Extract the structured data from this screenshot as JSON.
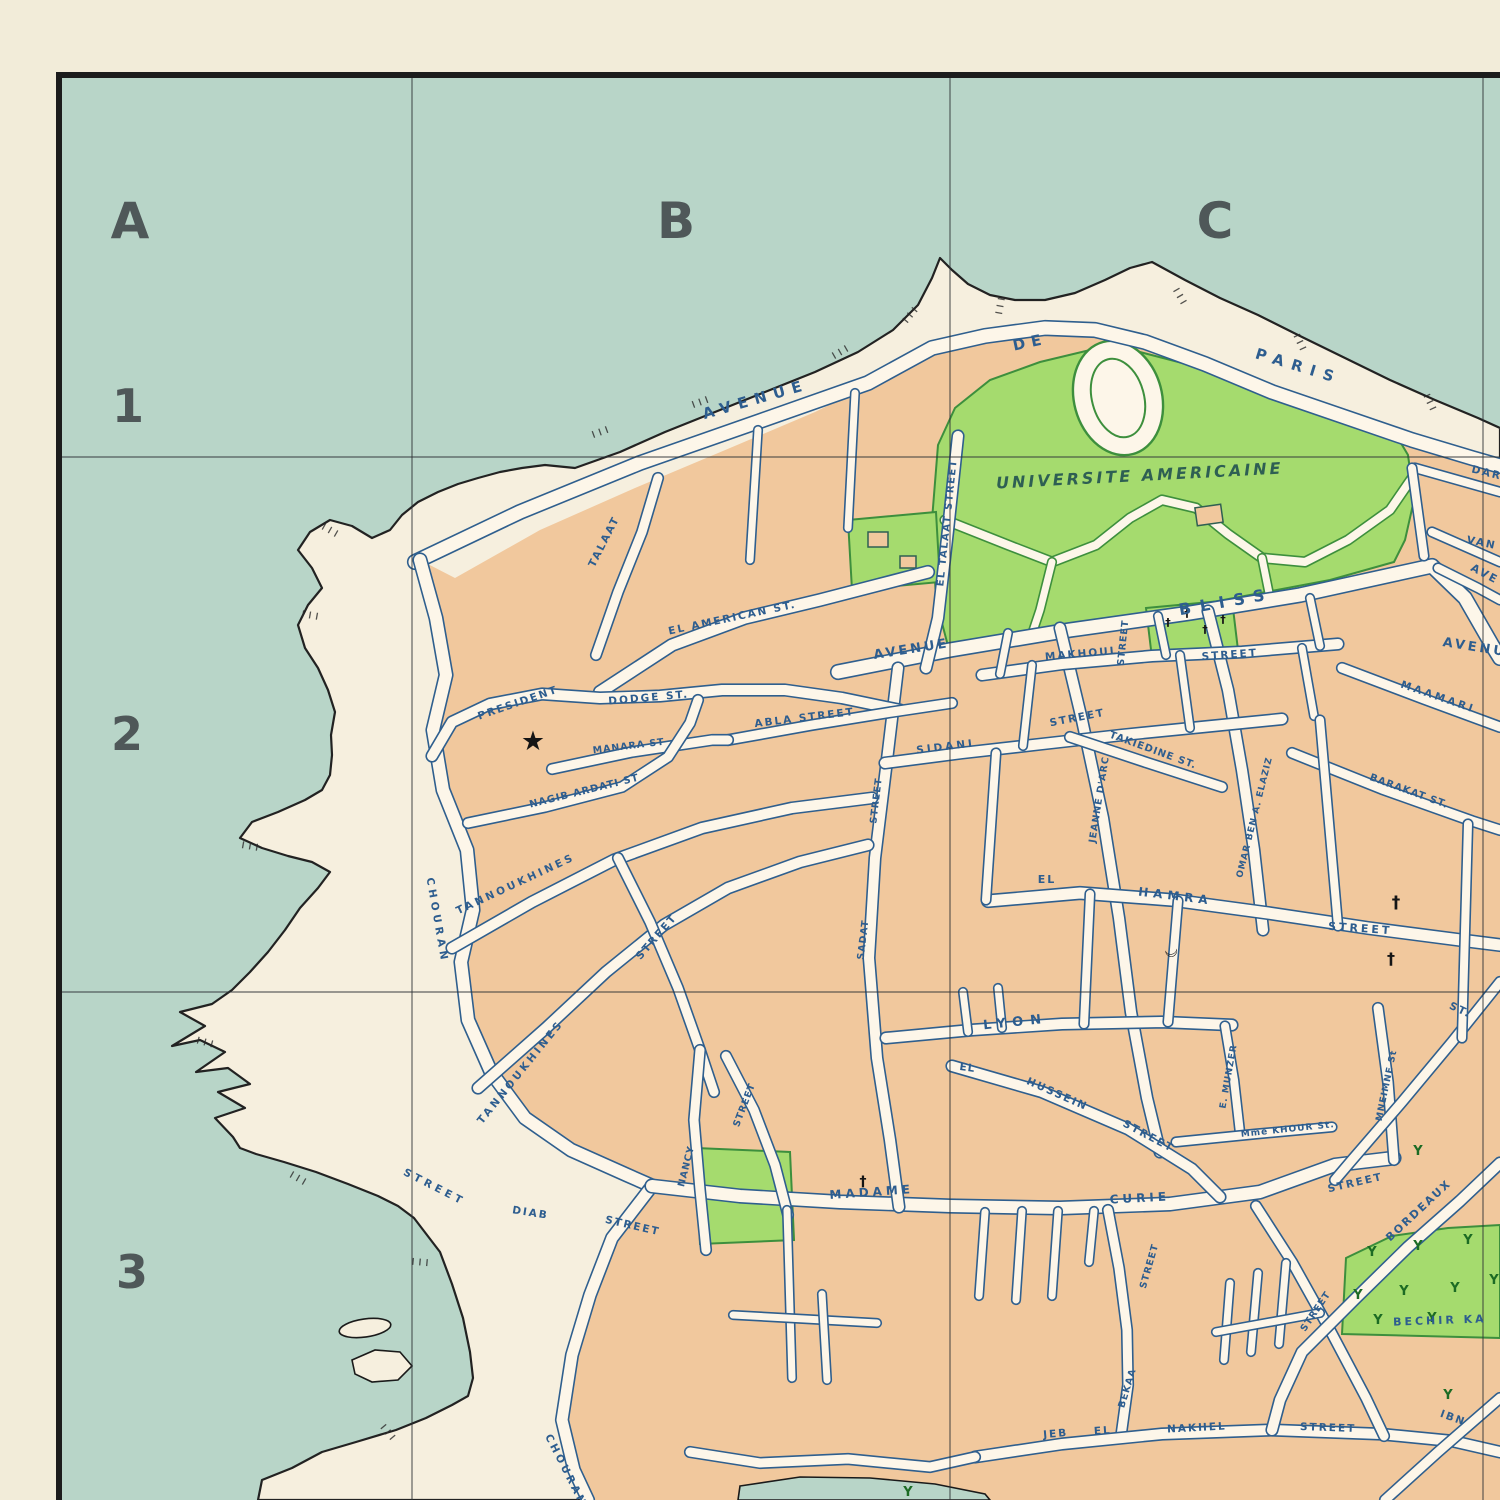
{
  "map_kind": "vintage-city-plan",
  "colors": {
    "sea": "#b8d5c8",
    "paper": "#f2ecd9",
    "land": "#f6efde",
    "block": "#f1c89d",
    "road": "#fdf6e9",
    "road_edge": "#2f5f8e",
    "park": "#a5db6e",
    "park_edge": "#3d8f3d",
    "label": "#2d5d8f",
    "university_text": "#2e5f53",
    "ink": "#222222",
    "grid": "#2f3337"
  },
  "grid": {
    "border": {
      "top_y": 72,
      "left_x": 56,
      "thickness": 6
    },
    "vlines": [
      412,
      950,
      1483
    ],
    "hlines": [
      457,
      992
    ],
    "columns": [
      {
        "label": "A",
        "x": 130,
        "y": 238
      },
      {
        "label": "B",
        "x": 676,
        "y": 238
      },
      {
        "label": "C",
        "x": 1215,
        "y": 238
      }
    ],
    "rows": [
      {
        "label": "1",
        "x": 128,
        "y": 422
      },
      {
        "label": "2",
        "x": 127,
        "y": 750
      },
      {
        "label": "3",
        "x": 132,
        "y": 1288
      }
    ]
  },
  "street_labels": [
    {
      "t": "AVENUE",
      "x": 757,
      "y": 404,
      "r": -16,
      "s": 15,
      "sp": 7
    },
    {
      "t": "DE",
      "x": 1031,
      "y": 347,
      "r": -12,
      "s": 15,
      "sp": 6
    },
    {
      "t": "PARIS",
      "x": 1297,
      "y": 371,
      "r": 17,
      "s": 15,
      "sp": 8
    },
    {
      "t": "UNIVERSITE  AMERICAINE",
      "x": 1140,
      "y": 481,
      "r": -3,
      "s": 16,
      "sp": 3,
      "c": "uni"
    },
    {
      "t": "BLISS",
      "x": 1227,
      "y": 607,
      "r": -10,
      "s": 16,
      "sp": 9
    },
    {
      "t": "AVENUE",
      "x": 912,
      "y": 653,
      "r": -9,
      "s": 13,
      "sp": 3
    },
    {
      "t": "EL AMERICAN ST.",
      "x": 733,
      "y": 621,
      "r": -12,
      "s": 10.5,
      "sp": 2
    },
    {
      "t": "TALAAT",
      "x": 607,
      "y": 543,
      "r": -63,
      "s": 10.5,
      "sp": 2
    },
    {
      "t": "EL TALAAT STREET",
      "x": 950,
      "y": 523,
      "r": -84,
      "s": 10,
      "sp": 1.5
    },
    {
      "t": "MAKHOUL",
      "x": 1082,
      "y": 657,
      "r": -5,
      "s": 10.5,
      "sp": 2
    },
    {
      "t": "STREET",
      "x": 1230,
      "y": 658,
      "r": -4,
      "s": 10.5,
      "sp": 2
    },
    {
      "t": "MAAMARI",
      "x": 1437,
      "y": 700,
      "r": 19,
      "s": 10.5,
      "sp": 3
    },
    {
      "t": "SIDANI",
      "x": 946,
      "y": 750,
      "r": -7,
      "s": 10.5,
      "sp": 3
    },
    {
      "t": "STREET",
      "x": 1078,
      "y": 721,
      "r": -11,
      "s": 10.5,
      "sp": 2
    },
    {
      "t": "TAKIEDINE ST.",
      "x": 1152,
      "y": 753,
      "r": 20,
      "s": 10,
      "sp": 1
    },
    {
      "t": "BARAKAT ST.",
      "x": 1408,
      "y": 794,
      "r": 20,
      "s": 10,
      "sp": 1
    },
    {
      "t": "ABLA STREET",
      "x": 805,
      "y": 721,
      "r": -7,
      "s": 10.5,
      "sp": 2
    },
    {
      "t": "PRESIDENT",
      "x": 519,
      "y": 706,
      "r": -19,
      "s": 10.5,
      "sp": 2
    },
    {
      "t": "DODGE ST.",
      "x": 649,
      "y": 701,
      "r": -5,
      "s": 10.5,
      "sp": 2
    },
    {
      "t": "MANARA ST",
      "x": 629,
      "y": 749,
      "r": -7,
      "s": 9.5,
      "sp": 1
    },
    {
      "t": "NAGIB ARDATI ST",
      "x": 585,
      "y": 794,
      "r": -14,
      "s": 10,
      "sp": 1
    },
    {
      "t": "TANNOUKHINES",
      "x": 517,
      "y": 887,
      "r": -25,
      "s": 10.5,
      "sp": 3
    },
    {
      "t": "STREET",
      "x": 659,
      "y": 939,
      "r": -49,
      "s": 10.5,
      "sp": 2
    },
    {
      "t": "TANNOUKHINES",
      "x": 523,
      "y": 1074,
      "r": -51,
      "s": 10.5,
      "sp": 3
    },
    {
      "t": "CHOURAN",
      "x": 434,
      "y": 921,
      "r": 80,
      "s": 10.5,
      "sp": 4
    },
    {
      "t": "STREET",
      "x": 433,
      "y": 1190,
      "r": 27,
      "s": 10.5,
      "sp": 4
    },
    {
      "t": "DIAB",
      "x": 530,
      "y": 1216,
      "r": 9,
      "s": 10.5,
      "sp": 2
    },
    {
      "t": "STREET",
      "x": 632,
      "y": 1229,
      "r": 13,
      "s": 10.5,
      "sp": 2
    },
    {
      "t": "NANCY",
      "x": 689,
      "y": 1167,
      "r": -76,
      "s": 9.5,
      "sp": 1
    },
    {
      "t": "STREET",
      "x": 747,
      "y": 1106,
      "r": -69,
      "s": 9.5,
      "sp": 1
    },
    {
      "t": "STREET",
      "x": 879,
      "y": 801,
      "r": -83,
      "s": 9.5,
      "sp": 1
    },
    {
      "t": "SADAT",
      "x": 866,
      "y": 940,
      "r": -83,
      "s": 9.5,
      "sp": 1
    },
    {
      "t": "STREET",
      "x": 1126,
      "y": 643,
      "r": -84,
      "s": 9.5,
      "sp": 1
    },
    {
      "t": "JEANNE D'ARC",
      "x": 1102,
      "y": 800,
      "r": -81,
      "s": 9.5,
      "sp": 1
    },
    {
      "t": "OMAR BEN A. ELAZIZ",
      "x": 1257,
      "y": 818,
      "r": -76,
      "s": 9,
      "sp": 1
    },
    {
      "t": "EL",
      "x": 1047,
      "y": 883,
      "r": 0,
      "s": 11,
      "sp": 2
    },
    {
      "t": "HAMRA",
      "x": 1175,
      "y": 900,
      "r": 7,
      "s": 12,
      "sp": 5
    },
    {
      "t": "STREET",
      "x": 1360,
      "y": 932,
      "r": 4,
      "s": 11,
      "sp": 3
    },
    {
      "t": "LYON",
      "x": 1016,
      "y": 1026,
      "r": -6,
      "s": 13,
      "sp": 7
    },
    {
      "t": "EL",
      "x": 967,
      "y": 1071,
      "r": 8,
      "s": 10.5,
      "sp": 1
    },
    {
      "t": "HUSSEIN",
      "x": 1056,
      "y": 1097,
      "r": 24,
      "s": 10.5,
      "sp": 2
    },
    {
      "t": "STREET",
      "x": 1147,
      "y": 1139,
      "r": 28,
      "s": 10.5,
      "sp": 2
    },
    {
      "t": "E. MUNZER",
      "x": 1231,
      "y": 1077,
      "r": -80,
      "s": 9,
      "sp": 1
    },
    {
      "t": "Mme KHOUR St.",
      "x": 1288,
      "y": 1132,
      "r": -6,
      "s": 9,
      "sp": 1
    },
    {
      "t": "MNEIMNE St",
      "x": 1389,
      "y": 1086,
      "r": -78,
      "s": 9,
      "sp": 1
    },
    {
      "t": "ST.",
      "x": 1459,
      "y": 1013,
      "r": 25,
      "s": 10.5,
      "sp": 2
    },
    {
      "t": "STREET",
      "x": 1356,
      "y": 1186,
      "r": -13,
      "s": 10.5,
      "sp": 2
    },
    {
      "t": "BORDEAUX",
      "x": 1421,
      "y": 1213,
      "r": -43,
      "s": 11,
      "sp": 2
    },
    {
      "t": "MADAME",
      "x": 872,
      "y": 1196,
      "r": -4,
      "s": 12,
      "sp": 4
    },
    {
      "t": "CURIE",
      "x": 1140,
      "y": 1202,
      "r": -3,
      "s": 12,
      "sp": 4
    },
    {
      "t": "STREET",
      "x": 1152,
      "y": 1267,
      "r": -74,
      "s": 9.5,
      "sp": 1
    },
    {
      "t": "BEKAA",
      "x": 1130,
      "y": 1389,
      "r": -73,
      "s": 9.5,
      "sp": 1
    },
    {
      "t": "STREET",
      "x": 1318,
      "y": 1313,
      "r": -56,
      "s": 9.5,
      "sp": 1
    },
    {
      "t": "BECHIR KA",
      "x": 1440,
      "y": 1324,
      "r": -2,
      "s": 11,
      "sp": 3
    },
    {
      "t": "JEB",
      "x": 1056,
      "y": 1437,
      "r": -5,
      "s": 10.5,
      "sp": 2
    },
    {
      "t": "EL",
      "x": 1103,
      "y": 1434,
      "r": -4,
      "s": 10.5,
      "sp": 2
    },
    {
      "t": "NAKHEL",
      "x": 1197,
      "y": 1431,
      "r": -3,
      "s": 10.5,
      "sp": 2
    },
    {
      "t": "STREET",
      "x": 1328,
      "y": 1431,
      "r": 2,
      "s": 10.5,
      "sp": 2
    },
    {
      "t": "IBN",
      "x": 1452,
      "y": 1421,
      "r": 20,
      "s": 10.5,
      "sp": 2
    },
    {
      "t": "DAR",
      "x": 1486,
      "y": 476,
      "r": 14,
      "s": 10.5,
      "sp": 2
    },
    {
      "t": "VAN",
      "x": 1481,
      "y": 546,
      "r": 12,
      "s": 10.5,
      "sp": 2
    },
    {
      "t": "AVE",
      "x": 1483,
      "y": 577,
      "r": 28,
      "s": 11,
      "sp": 2
    },
    {
      "t": "AVENUE",
      "x": 1480,
      "y": 652,
      "r": 9,
      "s": 13,
      "sp": 3
    },
    {
      "t": "CHOURAN",
      "x": 563,
      "y": 1472,
      "r": 63,
      "s": 10.5,
      "sp": 3
    }
  ],
  "symbols": {
    "star": {
      "glyph": "★",
      "x": 533,
      "y": 750,
      "s": 27
    },
    "crescent": {
      "glyph": "☾",
      "x": 1177,
      "y": 950,
      "s": 16,
      "r": -100
    },
    "crosses": [
      {
        "x": 1168,
        "y": 626,
        "s": 11
      },
      {
        "x": 1187,
        "y": 617,
        "s": 11
      },
      {
        "x": 1205,
        "y": 633,
        "s": 11
      },
      {
        "x": 1223,
        "y": 623,
        "s": 11
      },
      {
        "x": 1396,
        "y": 908,
        "s": 17
      },
      {
        "x": 1391,
        "y": 964,
        "s": 16
      },
      {
        "x": 863,
        "y": 1186,
        "s": 14
      }
    ],
    "trees": [
      {
        "x": 1372,
        "y": 1256
      },
      {
        "x": 1418,
        "y": 1250
      },
      {
        "x": 1468,
        "y": 1244
      },
      {
        "x": 1358,
        "y": 1299
      },
      {
        "x": 1404,
        "y": 1295
      },
      {
        "x": 1455,
        "y": 1292
      },
      {
        "x": 1494,
        "y": 1284
      },
      {
        "x": 1432,
        "y": 1322
      },
      {
        "x": 1378,
        "y": 1324
      },
      {
        "x": 1418,
        "y": 1155
      },
      {
        "x": 1448,
        "y": 1399
      },
      {
        "x": 908,
        "y": 1496
      }
    ],
    "rocks": [
      {
        "x": 600,
        "y": 432,
        "a": 70
      },
      {
        "x": 700,
        "y": 402,
        "a": 70
      },
      {
        "x": 840,
        "y": 352,
        "a": 60
      },
      {
        "x": 910,
        "y": 315,
        "a": 40
      },
      {
        "x": 1000,
        "y": 306,
        "a": 10
      },
      {
        "x": 1180,
        "y": 296,
        "a": -30
      },
      {
        "x": 1300,
        "y": 342,
        "a": -25
      },
      {
        "x": 1430,
        "y": 402,
        "a": -25
      },
      {
        "x": 250,
        "y": 846,
        "a": -80
      },
      {
        "x": 205,
        "y": 1042,
        "a": -75
      },
      {
        "x": 298,
        "y": 1178,
        "a": -60
      },
      {
        "x": 420,
        "y": 1262,
        "a": -85
      },
      {
        "x": 388,
        "y": 1432,
        "a": -40
      },
      {
        "x": 330,
        "y": 530,
        "a": -60
      },
      {
        "x": 310,
        "y": 615,
        "a": -80
      }
    ]
  }
}
